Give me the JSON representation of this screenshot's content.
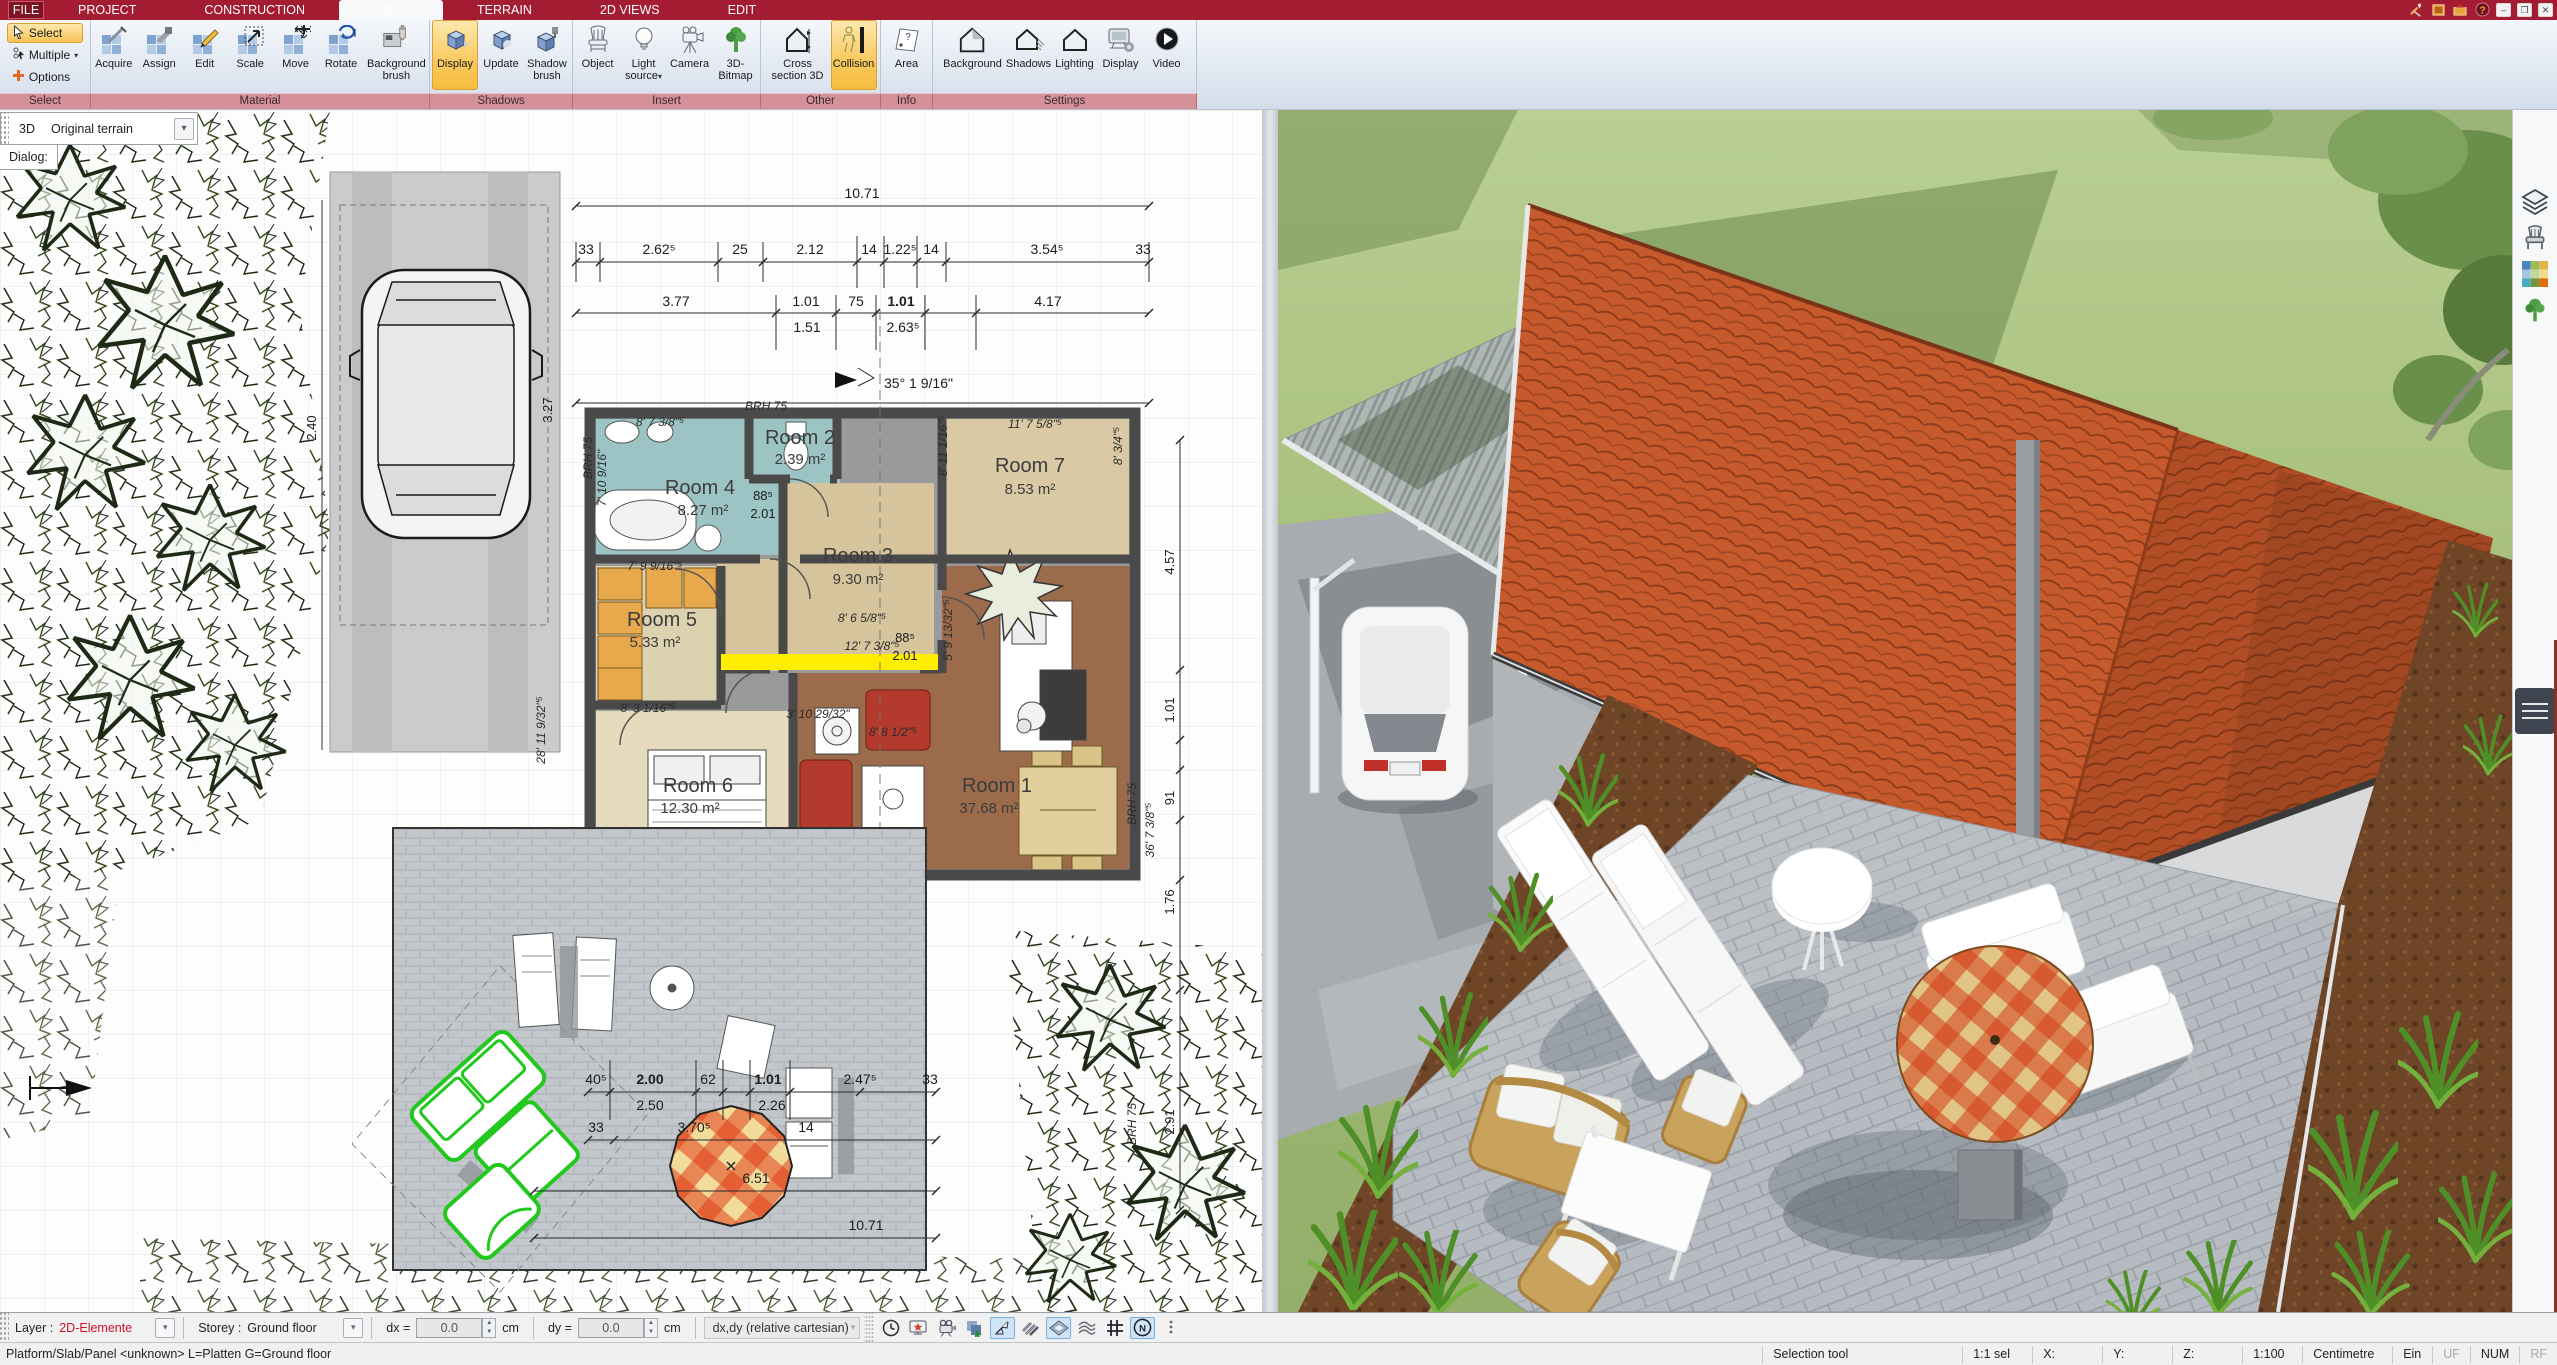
{
  "window": {
    "tabs": [
      "FILE",
      "PROJECT",
      "CONSTRUCTION",
      "3D",
      "TERRAIN",
      "2D VIEWS",
      "EDIT"
    ],
    "active_tab": "3D",
    "titlebar_icons": [
      "tools-icon",
      "addon-icon",
      "publish-icon",
      "help-icon"
    ],
    "window_buttons": [
      "minimize",
      "restore",
      "close"
    ]
  },
  "ribbon": {
    "groups": [
      {
        "label": "Select",
        "items": [
          {
            "label": "Select"
          },
          {
            "label": "Multiple"
          },
          {
            "label": "Options"
          }
        ]
      },
      {
        "label": "Material",
        "items": [
          {
            "label": "Acquire"
          },
          {
            "label": "Assign"
          },
          {
            "label": "Edit"
          },
          {
            "label": "Scale"
          },
          {
            "label": "Move"
          },
          {
            "label": "Rotate"
          },
          {
            "label": "Background brush"
          }
        ]
      },
      {
        "label": "Shadows",
        "items": [
          {
            "label": "Display"
          },
          {
            "label": "Update"
          },
          {
            "label": "Shadow brush"
          }
        ]
      },
      {
        "label": "Insert",
        "items": [
          {
            "label": "Object"
          },
          {
            "label": "Light source"
          },
          {
            "label": "Camera"
          },
          {
            "label": "3D-Bitmap"
          }
        ]
      },
      {
        "label": "Other",
        "items": [
          {
            "label": "Cross section 3D"
          },
          {
            "label": "Collision"
          }
        ]
      },
      {
        "label": "Info",
        "items": [
          {
            "label": "Area"
          }
        ]
      },
      {
        "label": "Settings",
        "items": [
          {
            "label": "Background"
          },
          {
            "label": "Shadows"
          },
          {
            "label": "Lighting"
          },
          {
            "label": "Display"
          },
          {
            "label": "Video"
          }
        ]
      }
    ],
    "active_items": [
      "Select",
      "Display",
      "Collision"
    ]
  },
  "panel": {
    "view_label": "3D",
    "terrain_value": "Original terrain",
    "dialog_label": "Dialog:"
  },
  "plan": {
    "rooms": [
      {
        "name": "Room 4",
        "area": "8.27 m²"
      },
      {
        "name": "Room 2",
        "area": "2.39 m²"
      },
      {
        "name": "Room 7",
        "area": "8.53 m²"
      },
      {
        "name": "Room 3",
        "area": "9.30 m²"
      },
      {
        "name": "Room 5",
        "area": "5.33 m²"
      },
      {
        "name": "Room 6",
        "area": "12.30 m²"
      },
      {
        "name": "Room 1",
        "area": "37.68 m²"
      }
    ],
    "total_width": "10.71",
    "dim_row_a": [
      "33",
      "2.62⁵",
      "25",
      "2.12",
      "14",
      "1.22⁵",
      "14",
      "3.54⁵",
      "33"
    ],
    "dim_row_b": [
      "3.77",
      "1.01",
      "75",
      "1.01",
      "4.17"
    ],
    "dim_row_b2": [
      "1.51",
      "2.63⁵"
    ],
    "angle_label": "35° 1 9/16\"",
    "terrace_row_a": [
      "40⁵",
      "2.00",
      "62",
      "1.01",
      "2.47⁵",
      "33"
    ],
    "terrace_row_a2": [
      "2.50",
      "2.26"
    ],
    "terrace_row_b": [
      "33",
      "3.70⁵",
      "14"
    ],
    "terrace_width": "6.51",
    "terrace_total": "10.71",
    "side_dims": [
      "4.57",
      "1.01",
      "91",
      "1.76",
      "2.91"
    ],
    "side_note": "36' 7 3/8\"⁵",
    "car_dims": [
      "2.40",
      "3.27",
      "28' 11 9/32\"⁵"
    ],
    "notes": [
      "8' 7 3/8\"⁵",
      "11' 7 5/8\"⁵",
      "7' 9 9/16\"⁵",
      "8' 6 5/8\"⁵",
      "12' 7 3/8\"⁵",
      "8' 3 1/16\"⁵",
      "12' 1 31/32\"⁵",
      "3' 10 29/32\"",
      "8' 8 1/2\"⁵",
      "7' 10 9/16\"",
      "5' 9 13/32\"⁵",
      "8' 11 1/16\"⁵",
      "8' 3/4\"⁵",
      "11' 7 7/32\"⁵",
      "21' 4 3/8\"⁵",
      "88⁵",
      "2.01",
      "BRH 75"
    ]
  },
  "right_strip": {
    "icons": [
      "layers-icon",
      "furniture-icon",
      "materials-icon",
      "plants-icon"
    ]
  },
  "toolbar_bottom": {
    "layer_label": "Layer :",
    "layer_value": "2D-Elemente",
    "storey_label": "Storey :",
    "storey_value": "Ground floor",
    "dx_label": "dx =",
    "dx_value": "0.0",
    "dx_unit": "cm",
    "dy_label": "dy =",
    "dy_value": "0.0",
    "dy_unit": "cm",
    "mode_value": "dx,dy (relative cartesian)",
    "icons": [
      "clock-icon",
      "snapshot-icon",
      "record-icon",
      "transfer-icon",
      "angle-icon",
      "hatch-icon",
      "workplane-icon",
      "contour-icon",
      "raster-icon",
      "north-icon"
    ]
  },
  "statusbar": {
    "left": "Platform/Slab/Panel <unknown> L=Platten G=Ground floor",
    "tool": "Selection tool",
    "sel": "1:1 sel",
    "x": "X:",
    "y": "Y:",
    "z": "Z:",
    "scale": "1:100",
    "unit": "Centimetre",
    "ein": "Ein",
    "uf": "UF",
    "num": "NUM",
    "rf": "RF"
  },
  "colors": {
    "titlebar_red": "#a31c31",
    "highlight_orange": "#f8c455",
    "group_label_rose": "#d59199",
    "layer_value_red": "#cc1122",
    "selection_green": "#22c81e",
    "marker_yellow": "#ffee00",
    "roof_orange": "#c75a2c",
    "lawn_green": "#a5bd79",
    "room_teal": "#9cc4c4",
    "room_tan": "#d9c9a4",
    "room_brown": "#9b6b4b",
    "wardrobe_orange": "#e8a84c"
  }
}
